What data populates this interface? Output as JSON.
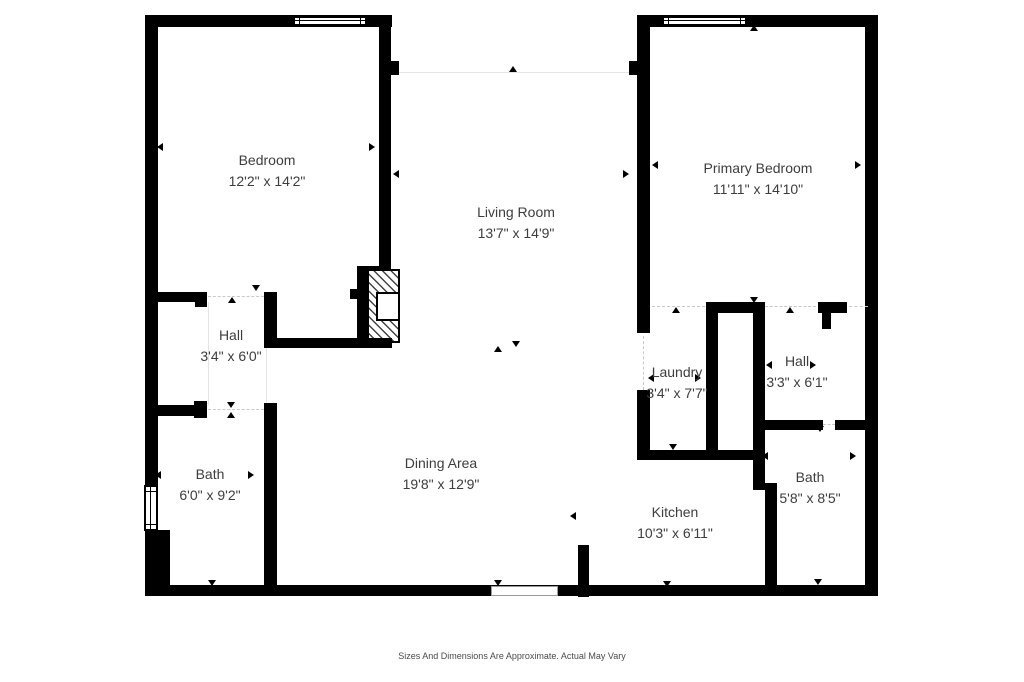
{
  "type": "floor_plan",
  "rooms": {
    "bedroom": {
      "name": "Bedroom",
      "dims": "12'2\" x 14'2\""
    },
    "primary_bedroom": {
      "name": "Primary Bedroom",
      "dims": "11'11\" x 14'10\""
    },
    "living_room": {
      "name": "Living Room",
      "dims": "13'7\" x 14'9\""
    },
    "hall_left": {
      "name": "Hall",
      "dims": "3'4\" x 6'0\""
    },
    "laundry": {
      "name": "Laundry",
      "dims": "3'4\" x 7'7\""
    },
    "hall_right": {
      "name": "Hall",
      "dims": "3'3\" x 6'1\""
    },
    "bath_left": {
      "name": "Bath",
      "dims": "6'0\" x 9'2\""
    },
    "dining_area": {
      "name": "Dining Area",
      "dims": "19'8\" x 12'9\""
    },
    "kitchen": {
      "name": "Kitchen",
      "dims": "10'3\" x 6'11\""
    },
    "bath_right": {
      "name": "Bath",
      "dims": "5'8\" x 8'5\""
    }
  },
  "footer": {
    "disclaimer": "Sizes And Dimensions Are Approximate. Actual May Vary"
  },
  "colors": {
    "wall": "#000000",
    "text": "#3d3d3d",
    "open_boundary": "#e4e4e4",
    "background": "#ffffff"
  }
}
